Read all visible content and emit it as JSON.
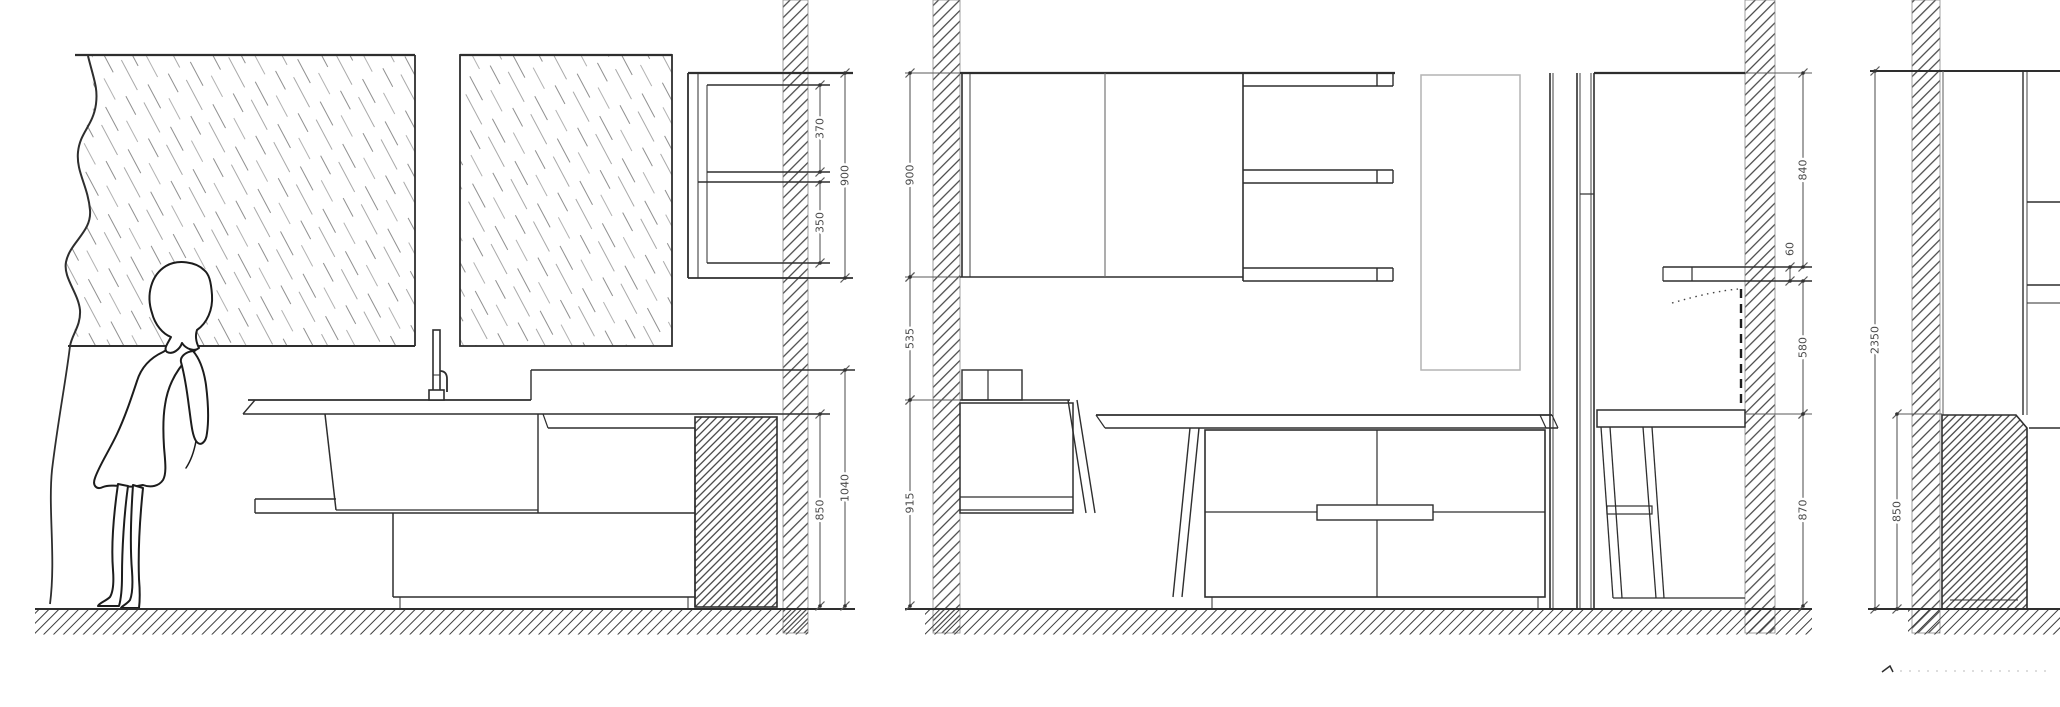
{
  "drawing": {
    "type": "technical-elevation",
    "title": "kitchen-elevations",
    "palette": {
      "background": "#ffffff",
      "line": "#2e2e2e",
      "line_light": "#8c8c8c",
      "dim_line": "#5a5a5a",
      "dim_text": "#4a4a4a",
      "faint": "#b4b4b4",
      "hatch": "#3a3a3a"
    },
    "views": [
      {
        "id": "elevation-left"
      },
      {
        "id": "elevation-middle"
      },
      {
        "id": "elevation-right"
      }
    ],
    "dimensions": [
      {
        "id": "dim-370",
        "view": "elevation-left",
        "value": "370",
        "x": 820,
        "y1": 85,
        "y2": 172
      },
      {
        "id": "dim-350",
        "view": "elevation-left",
        "value": "350",
        "x": 820,
        "y1": 182,
        "y2": 263
      },
      {
        "id": "dim-900-left",
        "view": "elevation-left",
        "value": "900",
        "x": 845,
        "y1": 73,
        "y2": 278
      },
      {
        "id": "dim-850-left",
        "view": "elevation-left",
        "value": "850",
        "x": 820,
        "y1": 414,
        "y2": 606
      },
      {
        "id": "dim-1040",
        "view": "elevation-left",
        "value": "1040",
        "x": 845,
        "y1": 370,
        "y2": 606
      },
      {
        "id": "dim-900-mid",
        "view": "elevation-middle",
        "value": "900",
        "x": 910,
        "y1": 73,
        "y2": 277
      },
      {
        "id": "dim-535",
        "view": "elevation-middle",
        "value": "535",
        "x": 910,
        "y1": 277,
        "y2": 400
      },
      {
        "id": "dim-915",
        "view": "elevation-middle",
        "value": "915",
        "x": 910,
        "y1": 400,
        "y2": 606
      },
      {
        "id": "dim-840",
        "view": "elevation-middle",
        "value": "840",
        "x": 1803,
        "y1": 73,
        "y2": 267
      },
      {
        "id": "dim-60",
        "view": "elevation-middle",
        "value": "60",
        "x": 1790,
        "y1": 267,
        "y2": 281,
        "ly": 249
      },
      {
        "id": "dim-580",
        "view": "elevation-middle",
        "value": "580",
        "x": 1803,
        "y1": 281,
        "y2": 414
      },
      {
        "id": "dim-870",
        "view": "elevation-middle",
        "value": "870",
        "x": 1803,
        "y1": 414,
        "y2": 606
      },
      {
        "id": "dim-2350",
        "view": "elevation-right",
        "value": "2350",
        "x": 1875,
        "y1": 71,
        "y2": 609
      },
      {
        "id": "dim-850-right",
        "view": "elevation-right",
        "value": "850",
        "x": 1897,
        "y1": 414,
        "y2": 609
      }
    ]
  }
}
